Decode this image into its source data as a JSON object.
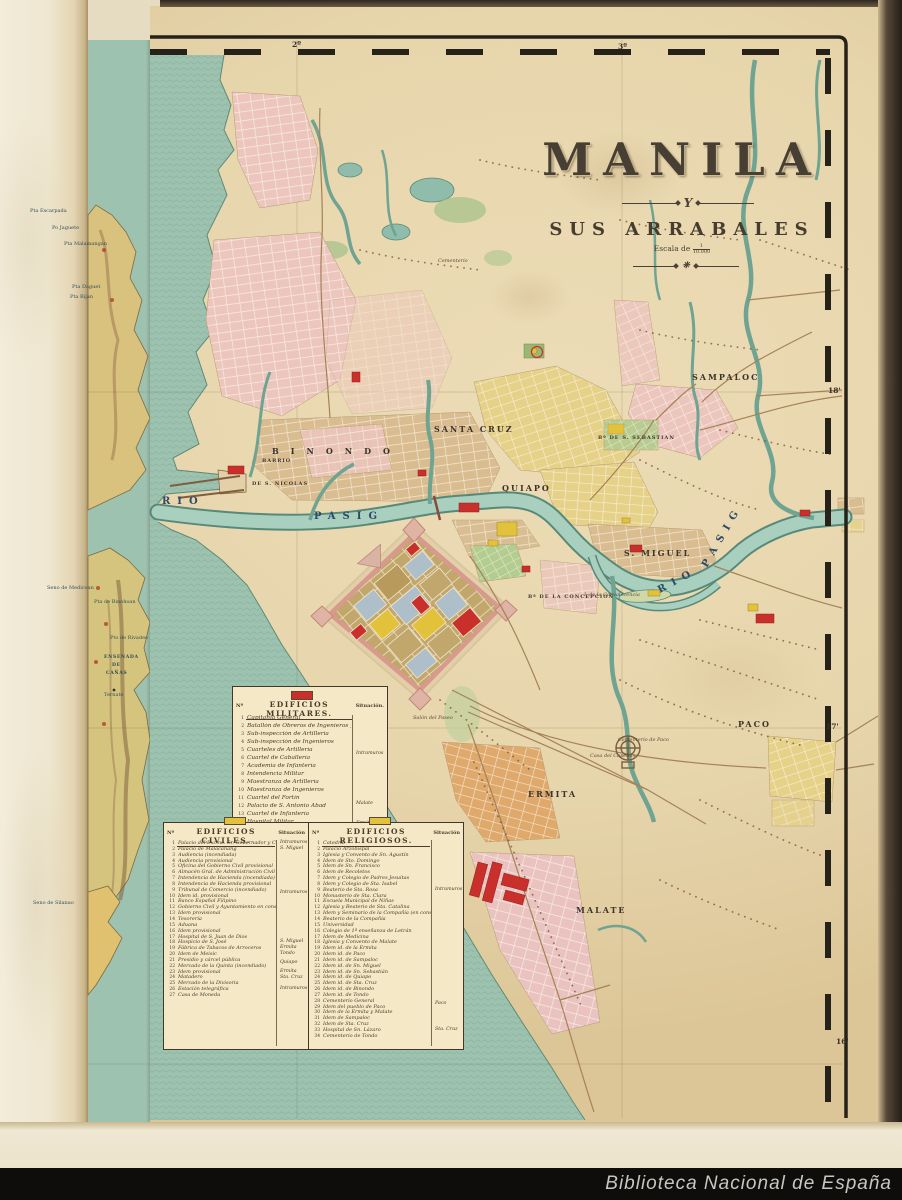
{
  "scan": {
    "watermark": "Biblioteca Nacional de España",
    "shelfmark_red": "R. 6569",
    "pencil_note": "II D/3 2"
  },
  "title_block": {
    "title": "MANILA",
    "connector": "Y",
    "subtitle": "SUS ARRABALES",
    "scale_label": "Escala de",
    "scale_num": "1",
    "scale_den": "10.000"
  },
  "stamp": {
    "text_top": "BIBLIOTECA NACIONAL",
    "text_bottom": "MADRID"
  },
  "colors": {
    "paper": "#e7d5ac",
    "sea": "#9dc3b0",
    "military_red": "#c9302c",
    "civil_yellow": "#e2c23a",
    "religious_yellow": "#e2c23a",
    "stamp_purple": "#7b5ca8",
    "watermark_bar": "#0e0d0b",
    "river": "#a9cfbf"
  },
  "legends": {
    "militares": {
      "header": "EDIFICIOS MILITARES.",
      "col_num": "Nº",
      "col_sit": "Situación.",
      "rows": [
        "Capitanía General",
        "Batallón de Obreros de Ingenieros y Carabineros",
        "Sub-inspección de Artillería",
        "Sub-inspección de Ingenieros",
        "Cuarteles de Artillería",
        "Cuartel de Caballería",
        "Academia de Infantería",
        "Intendencia Militar",
        "Maestranza de Artillería",
        "Maestranza de Ingenieros",
        "Cuartel del Fortín",
        "Palacio de S. Antonio Abad",
        "Cuartel de Infantería",
        "Hospital Militar",
        "Cuartel del Rey",
        "Polvorín de Nagtajan"
      ],
      "situaciones": [
        {
          "label": "Intramuros",
          "row": 4.5
        },
        {
          "label": "Malate",
          "row": 10.8
        },
        {
          "label": "Ermita",
          "row": 13.2
        },
        {
          "label": "Nagtajan",
          "row": 15.2
        }
      ]
    },
    "civiles": {
      "header": "EDIFICIOS CIVILES.",
      "col_num": "Nº",
      "col_sit": "Situación",
      "rows": [
        "Palacio del Excmo. Sr. Gobernador y Capitán Gral.",
        "Palacio de Malacañang",
        "Audiencia (incendiada)",
        "Audiencia provisional",
        "Oficina del Gobierno Civil provisional",
        "Almacén Gral. de Administración Civil",
        "Intendencia de Hacienda (incendiada)",
        "Intendencia de Hacienda provisional",
        "Tribunal de Comercio (incendiado)",
        "Idem id. provisional",
        "Banco Español Filipino",
        "Gobierno Civil y Ayuntamiento en construcción",
        "Idem provisional",
        "Tesorería",
        "Aduana",
        "Idem provisional",
        "Hospital de S. Juan de Dios",
        "Hospicio de S. José",
        "Fábrica de Tabacos de Arroceros",
        "Idem de Meisic",
        "Presidio y cárcel pública",
        "Mercado de la Quinta (incendiado)",
        "Idem provisional",
        "Matadero",
        "Mercado de la Divisoria",
        "Estación telegráfica",
        "Casa de Moneda"
      ],
      "situaciones": [
        {
          "label": "Intramuros",
          "row": 0
        },
        {
          "label": "S. Miguel",
          "row": 1
        },
        {
          "label": "Intramuros",
          "row": 8.5
        },
        {
          "label": "S. Miguel",
          "row": 17
        },
        {
          "label": "Ermita",
          "row": 18
        },
        {
          "label": "Tondo",
          "row": 19
        },
        {
          "label": "Quiapo",
          "row": 20.5
        },
        {
          "label": "Ermita",
          "row": 22
        },
        {
          "label": "Sta. Cruz",
          "row": 23
        },
        {
          "label": "Intramuros",
          "row": 25
        }
      ]
    },
    "religiosos": {
      "header": "EDIFICIOS RELIGIOSOS.",
      "col_num": "Nº",
      "col_sit": "Situación",
      "rows": [
        "Catedral",
        "Palacio Arzobispal",
        "Iglesia y Convento de Sn. Agustín",
        "Idem de Sto. Domingo",
        "Idem de Sn. Francisco",
        "Idem de Recoletos",
        "Idem y Colegio de Padres Jesuitas",
        "Idem y Colegio de Sta. Isabel",
        "Beaterio de Sta. Rosa",
        "Monasterio de Sta. Clara",
        "Escuela Municipal de Niñas",
        "Iglesia y Beaterio de Sta. Catalina",
        "Idem y Seminario de la Compañía (en construcción)",
        "Beaterio de la Compañía",
        "Universidad",
        "Colegio de 1ª enseñanza de Letrán",
        "Idem de Medicina",
        "Iglesia y Convento de Malate",
        "Idem id. de la Ermita",
        "Idem id. de Paco",
        "Idem id. de Sampaloc",
        "Idem id. de Sn. Miguel",
        "Idem id. de Sn. Sebastián",
        "Idem id. de Quiapo",
        "Idem id. de Sta. Cruz",
        "Idem id. de Binondo",
        "Idem id. de Tondo",
        "Cementerio General",
        "Idem del pueblo de Paco",
        "Idem de la Ermita y Malate",
        "Idem de Sampaloc",
        "Idem de Sta. Cruz",
        "Hospital de Sn. Lázaro",
        "Cementerio de Tondo"
      ],
      "situaciones": [
        {
          "label": "Intramuros",
          "row": 8
        },
        {
          "label": "Paco",
          "row": 27.5
        },
        {
          "label": "Sta. Cruz",
          "row": 32
        }
      ]
    }
  },
  "border_labels": [
    {
      "t": "2º",
      "x": 292,
      "y": 40,
      "c": "coord"
    },
    {
      "t": "3º",
      "x": 618,
      "y": 42,
      "c": "coord"
    },
    {
      "t": "18'",
      "x": 828,
      "y": 386,
      "c": "coord"
    },
    {
      "t": "17'",
      "x": 826,
      "y": 722,
      "c": "coord"
    },
    {
      "t": "16'",
      "x": 836,
      "y": 1037,
      "c": "coord"
    }
  ],
  "map_labels": [
    {
      "t": "RIO",
      "x": 162,
      "y": 496,
      "c": "river"
    },
    {
      "t": "PASIG",
      "x": 314,
      "y": 511,
      "c": "river"
    },
    {
      "t": "RIO",
      "x": 656,
      "y": 586,
      "c": "river",
      "r": -28
    },
    {
      "t": "PASIG",
      "x": 700,
      "y": 564,
      "c": "river",
      "r": -60
    },
    {
      "t": "BINONDO",
      "x": 272,
      "y": 446,
      "c": "district sp3"
    },
    {
      "t": "SANTA CRUZ",
      "x": 434,
      "y": 424,
      "c": "district sp1"
    },
    {
      "t": "QUIAPO",
      "x": 502,
      "y": 483,
      "c": "district sp1"
    },
    {
      "t": "S. MIGUEL",
      "x": 624,
      "y": 548,
      "c": "district sp1"
    },
    {
      "t": "SAMPALOC",
      "x": 692,
      "y": 372,
      "c": "district sp1"
    },
    {
      "t": "Bº DE S. SEBASTIAN",
      "x": 598,
      "y": 435,
      "c": "small"
    },
    {
      "t": "BARRIO",
      "x": 262,
      "y": 458,
      "c": "small"
    },
    {
      "t": "DE S. NICOLAS",
      "x": 252,
      "y": 481,
      "c": "small"
    },
    {
      "t": "Bª DE LA CONCEPCION",
      "x": 528,
      "y": 594,
      "c": "small"
    },
    {
      "t": "ERMITA",
      "x": 528,
      "y": 789,
      "c": "district sp1"
    },
    {
      "t": "MALATE",
      "x": 576,
      "y": 905,
      "c": "district sp1"
    },
    {
      "t": "PACO",
      "x": 738,
      "y": 719,
      "c": "district sp1"
    },
    {
      "t": "I. de la Convalecencia",
      "x": 584,
      "y": 592,
      "c": "tiny-italic"
    },
    {
      "t": "Cementerio de Paco",
      "x": 618,
      "y": 737,
      "c": "tiny-italic"
    },
    {
      "t": "Casa del Capellán",
      "x": 590,
      "y": 753,
      "c": "tiny-italic"
    },
    {
      "t": "Salón del Paseo",
      "x": 413,
      "y": 715,
      "c": "tiny-italic"
    },
    {
      "t": "Cementerio",
      "x": 438,
      "y": 258,
      "c": "tiny-italic"
    },
    {
      "t": "Pta Escarpada",
      "x": 30,
      "y": 208,
      "c": "panel-tiny"
    },
    {
      "t": "Po Jaguete",
      "x": 52,
      "y": 225,
      "c": "panel-tiny"
    },
    {
      "t": "Pta Malamangan",
      "x": 64,
      "y": 241,
      "c": "panel-tiny"
    },
    {
      "t": "Pta Daguet",
      "x": 72,
      "y": 284,
      "c": "panel-tiny"
    },
    {
      "t": "Pta Bijan",
      "x": 70,
      "y": 294,
      "c": "panel-tiny"
    },
    {
      "t": "Seno de Medicoan",
      "x": 47,
      "y": 585,
      "c": "panel-tiny"
    },
    {
      "t": "Pta de Binohoan",
      "x": 94,
      "y": 599,
      "c": "panel-tiny"
    },
    {
      "t": "Pto de Rivadeo",
      "x": 110,
      "y": 635,
      "c": "panel-tiny"
    },
    {
      "t": "ENSENADA",
      "x": 104,
      "y": 655,
      "c": "panel-caps"
    },
    {
      "t": "DE",
      "x": 112,
      "y": 663,
      "c": "panel-caps"
    },
    {
      "t": "CAÑAS",
      "x": 106,
      "y": 671,
      "c": "panel-caps"
    },
    {
      "t": "Ternate",
      "x": 104,
      "y": 692,
      "c": "panel-tiny"
    },
    {
      "t": "Seno de Silanao",
      "x": 33,
      "y": 900,
      "c": "panel-tiny"
    }
  ]
}
